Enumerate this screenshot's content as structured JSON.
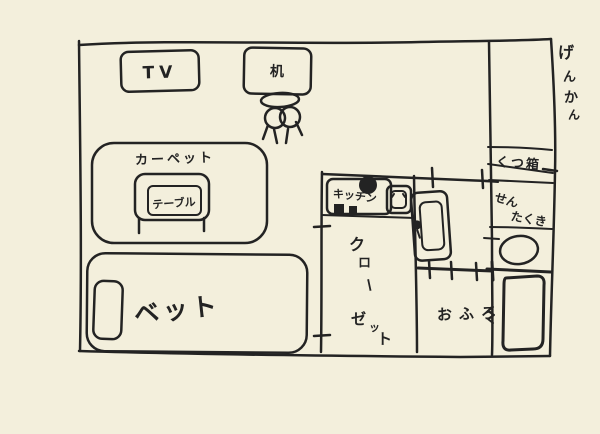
{
  "canvas": {
    "background_color": "#f3efdc",
    "ink_color": "#232323",
    "description": "hand-drawn one-room apartment floor plan sketch"
  },
  "floorplan": {
    "labels": {
      "tv": "TV",
      "desk": "机",
      "carpet": "カーペット",
      "table": "テーブル",
      "bed": "ベット",
      "kitchen": "キッチン",
      "closet": "クローゼット",
      "closet_chars": [
        "ク",
        "ロ",
        "ー",
        "ゼ",
        "ッ",
        "ト"
      ],
      "bath": "おふろ",
      "entrance": "げんかん",
      "entrance_chars": [
        "げ",
        "ん",
        "か",
        "ん"
      ],
      "shoe_box": "くつ箱",
      "washing_machine": "せんたくき",
      "washing_machine_lines": [
        "せん",
        "たくき"
      ]
    }
  }
}
